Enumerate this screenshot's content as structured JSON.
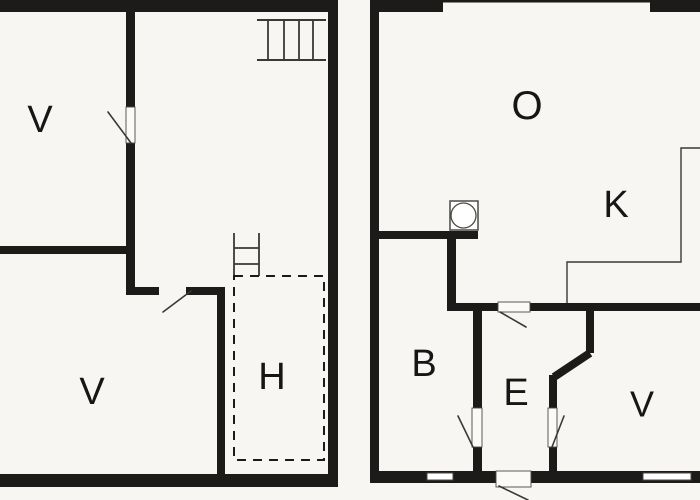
{
  "floorplan": {
    "canvas": {
      "width": 700,
      "height": 500
    },
    "colors": {
      "background": "#f7f6f2",
      "wall": "#1c1b19",
      "thin_line": "#3a3935",
      "outline": "#4a4945",
      "label": "#161616",
      "opening_fill": "#fbfaf7",
      "window_fill": "#ffffff"
    },
    "plans": [
      {
        "name": "left-plan",
        "room_labels": [
          {
            "id": "room-label-v-upper",
            "text": "V",
            "x": 40,
            "y": 120,
            "size": 38
          },
          {
            "id": "room-label-v-lower",
            "text": "V",
            "x": 92,
            "y": 392,
            "size": 38
          },
          {
            "id": "room-label-h",
            "text": "H",
            "x": 272,
            "y": 377,
            "size": 38
          }
        ]
      },
      {
        "name": "right-plan",
        "room_labels": [
          {
            "id": "room-label-o",
            "text": "O",
            "x": 527,
            "y": 106,
            "size": 40
          },
          {
            "id": "room-label-k",
            "text": "K",
            "x": 616,
            "y": 205,
            "size": 38
          },
          {
            "id": "room-label-b",
            "text": "B",
            "x": 424,
            "y": 364,
            "size": 38
          },
          {
            "id": "room-label-e",
            "text": "E",
            "x": 516,
            "y": 393,
            "size": 38
          },
          {
            "id": "room-label-v",
            "text": "V",
            "x": 642,
            "y": 404,
            "size": 36
          }
        ]
      }
    ],
    "walls": [
      {
        "name": "left-plan-top-wall",
        "rect": [
          0,
          0,
          338,
          12
        ]
      },
      {
        "name": "left-plan-right-wall",
        "rect": [
          328,
          0,
          10,
          487
        ]
      },
      {
        "name": "left-plan-bottom-wall",
        "rect": [
          0,
          474,
          338,
          13
        ]
      },
      {
        "name": "wall-upper-v-divider-top",
        "rect": [
          126,
          12,
          9,
          95
        ]
      },
      {
        "name": "wall-upper-v-divider-bottom",
        "rect": [
          126,
          143,
          9,
          146
        ]
      },
      {
        "name": "wall-v-v-divider",
        "rect": [
          0,
          246,
          135,
          8
        ]
      },
      {
        "name": "wall-hall-left-segment",
        "rect": [
          126,
          287,
          33,
          8
        ]
      },
      {
        "name": "wall-hall-right-segment",
        "rect": [
          186,
          287,
          39,
          8
        ]
      },
      {
        "name": "wall-lower-v-right",
        "rect": [
          217,
          295,
          8,
          179
        ]
      },
      {
        "name": "right-plan-top-wall-left",
        "rect": [
          370,
          0,
          73,
          12
        ]
      },
      {
        "name": "right-plan-top-window-line",
        "rect": [
          443,
          0,
          207,
          2.5
        ]
      },
      {
        "name": "right-plan-top-wall-right",
        "rect": [
          650,
          0,
          50,
          12
        ]
      },
      {
        "name": "right-plan-left-wall",
        "rect": [
          370,
          12,
          9,
          470
        ]
      },
      {
        "name": "right-plan-bottom-wall-left",
        "rect": [
          370,
          471,
          127,
          12
        ]
      },
      {
        "name": "right-plan-bottom-wall-right",
        "rect": [
          530,
          471,
          170,
          12
        ]
      },
      {
        "name": "wall-o-b-divider",
        "rect": [
          379,
          231,
          99,
          8
        ]
      },
      {
        "name": "wall-b-right-upper",
        "rect": [
          447,
          239,
          9,
          72
        ]
      },
      {
        "name": "wall-hallway-top-left",
        "rect": [
          447,
          303,
          51,
          8
        ]
      },
      {
        "name": "wall-hallway-top-right",
        "rect": [
          530,
          303,
          170,
          8
        ]
      },
      {
        "name": "wall-b-e-divider",
        "rect": [
          473,
          311,
          9,
          97
        ]
      },
      {
        "name": "wall-b-e-stub",
        "rect": [
          473,
          447,
          9,
          25
        ]
      },
      {
        "name": "wall-e-v-upper",
        "rect": [
          586,
          311,
          8,
          42
        ]
      },
      {
        "name": "wall-e-v-mid",
        "rect": [
          549,
          375,
          8,
          34
        ]
      },
      {
        "name": "wall-e-v-stub",
        "rect": [
          549,
          447,
          8,
          25
        ]
      }
    ],
    "angled_walls": [
      {
        "name": "wall-e-v-diagonal",
        "line": [
          590,
          353,
          554,
          377
        ],
        "width": 8
      }
    ],
    "windows": [
      {
        "name": "window-bottom-left",
        "rect": [
          427,
          473,
          26,
          7
        ]
      },
      {
        "name": "window-bottom-right",
        "rect": [
          643,
          473,
          48,
          7
        ]
      }
    ],
    "door_openings": [
      {
        "name": "door-opening-upper-v",
        "rect": [
          126,
          107,
          9,
          36
        ]
      },
      {
        "name": "door-opening-o-e",
        "rect": [
          498,
          302,
          32,
          10
        ]
      },
      {
        "name": "door-opening-b-e",
        "rect": [
          472,
          408,
          10,
          39
        ]
      },
      {
        "name": "door-opening-e-v",
        "rect": [
          548,
          408,
          9,
          39
        ]
      },
      {
        "name": "door-leaf-exterior",
        "rect": [
          496,
          471,
          35,
          16
        ]
      }
    ],
    "door_swings": [
      {
        "name": "door-swing-upper-v",
        "line": [
          108,
          112,
          131,
          143
        ]
      },
      {
        "name": "door-swing-lower-v",
        "line": [
          163,
          312,
          191,
          291
        ]
      },
      {
        "name": "door-swing-o-e",
        "line": [
          500,
          312,
          526,
          327
        ]
      },
      {
        "name": "door-swing-b-e",
        "line": [
          458,
          416,
          473,
          447
        ]
      },
      {
        "name": "door-swing-e-v",
        "line": [
          564,
          416,
          552,
          447
        ]
      },
      {
        "name": "door-swing-exterior",
        "line": [
          499,
          486,
          528,
          500
        ]
      }
    ],
    "thin_outlines": [
      {
        "name": "kitchen-counter-outline",
        "points": [
          [
            700,
            148
          ],
          [
            681,
            148
          ],
          [
            681,
            262
          ],
          [
            567,
            262
          ],
          [
            567,
            303
          ]
        ]
      }
    ],
    "symbols": {
      "stove": {
        "name": "stove-symbol",
        "rect": [
          450,
          201,
          28,
          29
        ],
        "circle": {
          "cx": 463.5,
          "cy": 215.5,
          "r": 12.5
        }
      },
      "ladder": {
        "name": "loft-ladder-symbol",
        "rails": [
          [
            234,
            233,
            234,
            276
          ],
          [
            259,
            233,
            259,
            276
          ]
        ],
        "rungs": [
          [
            234,
            248,
            259,
            248
          ],
          [
            234,
            264,
            259,
            264
          ]
        ]
      },
      "stairs": {
        "name": "stairs-symbol",
        "rails": [
          [
            257,
            20,
            326,
            20
          ],
          [
            257,
            60,
            326,
            60
          ]
        ],
        "steps": [
          [
            268,
            20,
            268,
            60
          ],
          [
            284,
            20,
            284,
            60
          ],
          [
            299,
            20,
            299,
            60
          ],
          [
            313,
            20,
            313,
            60
          ]
        ]
      }
    },
    "dashed_rooms": [
      {
        "name": "room-h-dashed-outline",
        "rect": [
          234,
          276,
          90,
          184
        ],
        "dash": "9 7"
      }
    ]
  }
}
